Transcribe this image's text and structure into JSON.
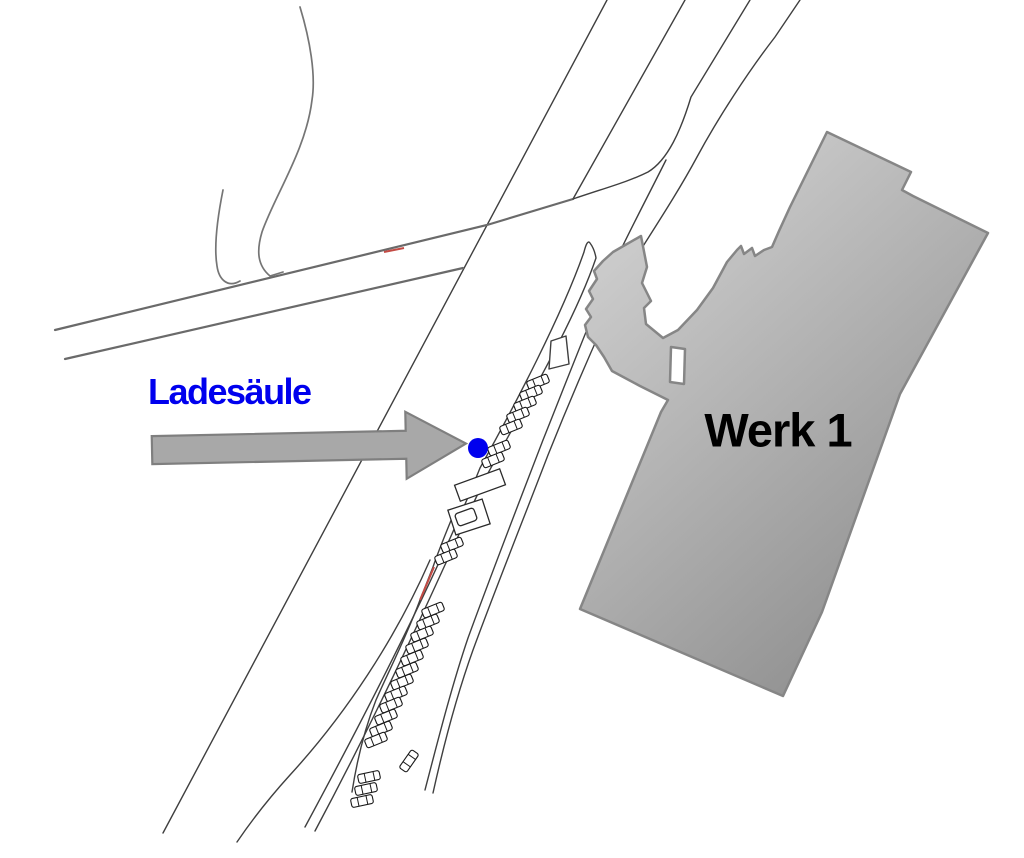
{
  "canvas": {
    "width": 1024,
    "height": 858,
    "background": "#ffffff"
  },
  "labels": {
    "charging_station": {
      "text": "Ladesäule",
      "color": "#0000EE",
      "x": 148,
      "y": 374,
      "font_size": 36
    },
    "building": {
      "text": "Werk 1",
      "color": "#000000",
      "x": 778,
      "y": 430,
      "font_size": 47
    }
  },
  "marker": {
    "x": 478,
    "y": 448,
    "radius": 10,
    "color": "#0000EE"
  },
  "arrow": {
    "fill": "#A8A8A8",
    "stroke": "#7F7F7F",
    "stroke_width": 2.2,
    "points": "152,433 406,433 406,414 466,447 406,481 406,461 152,461",
    "rotation": -1.2,
    "cx": 300,
    "cy": 447
  },
  "map": {
    "colors": {
      "thin": "#3f3f3f",
      "road": "#6a6a6a",
      "path": "#757575",
      "red": "#C34A44",
      "car_stroke": "#1a1a1a",
      "structure_stroke": "#2a2a2a"
    },
    "roads": [
      {
        "name": "main-road-left-edge",
        "d": "M607,0 L163,833",
        "cls": "thin"
      },
      {
        "name": "main-road-right-edge-upper",
        "d": "M685,0 L573,199",
        "cls": "thin"
      },
      {
        "name": "west-road-upper-edge",
        "d": "M55,330 L487,225 L573,199",
        "cls": "road"
      },
      {
        "name": "west-road-lower-edge",
        "d": "M65,359 L463,268",
        "cls": "road"
      },
      {
        "name": "branch-left-edge",
        "d": "M573,199 C605,188 628,182 648,172 C668,160 681,130 691,97 L750,0",
        "cls": "thin"
      },
      {
        "name": "branch-right-edge",
        "d": "M800,0 L775,37 C748,72 718,118 697,157 C676,196 651,233 630,267 C600,330 570,400 548,455 C525,515 495,590 473,650 C455,700 443,748 433,793",
        "cls": "thin"
      },
      {
        "name": "parking-lane-left-boundary",
        "d": "M666,160 C648,196 630,230 615,262 C590,320 565,385 543,440 C520,500 492,572 468,638 C452,685 438,740 425,790",
        "cls": "thin"
      },
      {
        "name": "median-island-outline",
        "d": "M305,827 C395,660 448,548 480,468 C515,405 562,315 584,252 C586,244 588,240 590,243 C593,247 595,252 596,258 C575,320 528,400 487,475 C452,545 405,662 315,831",
        "cls": "thin"
      },
      {
        "name": "roadside-line-lower",
        "d": "M430,560 C395,640 345,715 290,775 C270,797 252,820 237,842",
        "cls": "thin"
      },
      {
        "name": "parking-row-edge",
        "d": "M452,518 C443,540 437,555 433,567 L420,600 C405,640 390,668 376,700 C365,728 357,760 352,792",
        "cls": "thin"
      },
      {
        "name": "forest-path-long",
        "d": "M300,7 C310,40 316,75 312,100 C306,150 275,195 262,232 C256,252 258,266 270,276 L283,272",
        "cls": "path"
      },
      {
        "name": "forest-path-short",
        "d": "M223,190 C217,220 214,248 217,266 C219,280 228,288 240,281",
        "cls": "path"
      }
    ],
    "red_segments": [
      {
        "name": "red-mark-west-road",
        "d": "M384,252 L404,248"
      },
      {
        "name": "red-mark-parking-row",
        "d": "M434,567 L420,600"
      }
    ],
    "triangle": {
      "points": "551,341 566,336 569,364 549,369"
    },
    "structures": [
      {
        "x": 480,
        "y": 485,
        "w": 48,
        "h": 17,
        "angle": -20,
        "inner": false
      },
      {
        "x": 469,
        "y": 517,
        "w": 36,
        "h": 26,
        "angle": -18,
        "inner": false
      },
      {
        "x": 466,
        "y": 517,
        "w": 20,
        "h": 13,
        "angle": -20,
        "inner": true
      }
    ],
    "building": {
      "fill_light": "#d9d9d9",
      "fill_dark": "#8f8f8f",
      "stroke": "#868686",
      "stroke_width": 2.5,
      "path": "M827,132 L911,172 L902,190 L913,196 L988,233 L900,394 L822,612 L783,696 L580,609 L661,412 L668,400 L640,386 L612,371 L604,357 L596,345 L588,337 L585,325 L591,317 L586,309 L593,299 L589,291 L597,279 L594,271 L603,261 L613,252 L641,236 L647,267 L642,283 L651,301 L644,308 L646,324 L663,338 L678,330 L697,310 L713,288 L727,262 L737,250 L741,246 L744,254 L752,248 L755,256 L764,250 L772,247 L779,231 L790,207 Z M671,347 L685,349 L684,384 L670,382 Z"
    },
    "cars": {
      "length": 22,
      "width": 9,
      "items": [
        {
          "x": 538,
          "y": 382,
          "a": -22
        },
        {
          "x": 531,
          "y": 393,
          "a": -22
        },
        {
          "x": 525,
          "y": 404,
          "a": -22
        },
        {
          "x": 518,
          "y": 415,
          "a": -22
        },
        {
          "x": 511,
          "y": 427,
          "a": -22
        },
        {
          "x": 499,
          "y": 448,
          "a": -22
        },
        {
          "x": 493,
          "y": 460,
          "a": -22
        },
        {
          "x": 452,
          "y": 545,
          "a": -22
        },
        {
          "x": 446,
          "y": 557,
          "a": -22
        },
        {
          "x": 433,
          "y": 610,
          "a": -22
        },
        {
          "x": 428,
          "y": 622,
          "a": -22
        },
        {
          "x": 422,
          "y": 634,
          "a": -22
        },
        {
          "x": 417,
          "y": 646,
          "a": -22
        },
        {
          "x": 412,
          "y": 658,
          "a": -22
        },
        {
          "x": 407,
          "y": 670,
          "a": -22
        },
        {
          "x": 402,
          "y": 682,
          "a": -22
        },
        {
          "x": 396,
          "y": 694,
          "a": -22
        },
        {
          "x": 391,
          "y": 705,
          "a": -22
        },
        {
          "x": 386,
          "y": 717,
          "a": -22
        },
        {
          "x": 381,
          "y": 729,
          "a": -22
        },
        {
          "x": 376,
          "y": 740,
          "a": -22
        },
        {
          "x": 369,
          "y": 777,
          "a": -12
        },
        {
          "x": 366,
          "y": 789,
          "a": -12
        },
        {
          "x": 362,
          "y": 801,
          "a": -12
        },
        {
          "x": 409,
          "y": 761,
          "a": -55
        }
      ]
    }
  }
}
